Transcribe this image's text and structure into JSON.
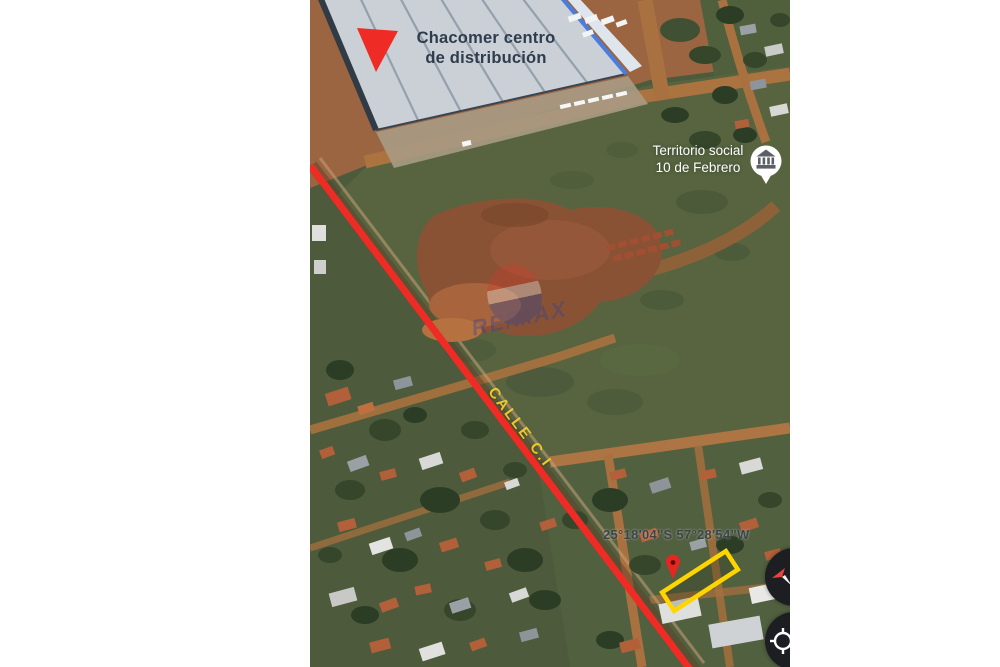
{
  "page": {
    "background_color": "#ffffff"
  },
  "map": {
    "annotations": {
      "warehouse_label_line1": "Chacomer centro",
      "warehouse_label_line2": "de distribución",
      "territory_label_line1": "Territorio social",
      "territory_label_line2": "10 de Febrero",
      "street_label": "CALLE C.I",
      "coordinates": "25°18'04\"S 57°28'54\"W",
      "watermark_text": "RE/MAX"
    },
    "colors": {
      "highlight_red": "#ee2b24",
      "street_label_yellow": "#e9c832",
      "property_outline_yellow": "#ffd500",
      "warehouse_label_navy": "#2e3c4e",
      "territory_label_white": "#ffffff",
      "coordinates_gray": "#3f4348",
      "watermark_blue": "#2441a0"
    },
    "icons": {
      "warehouse_marker": "red-triangle-marker",
      "territory_marker": "institution-place-marker-icon",
      "property_pin": "red-map-pin-icon",
      "compass_button": "compass-icon",
      "location_button": "my-location-icon"
    }
  }
}
